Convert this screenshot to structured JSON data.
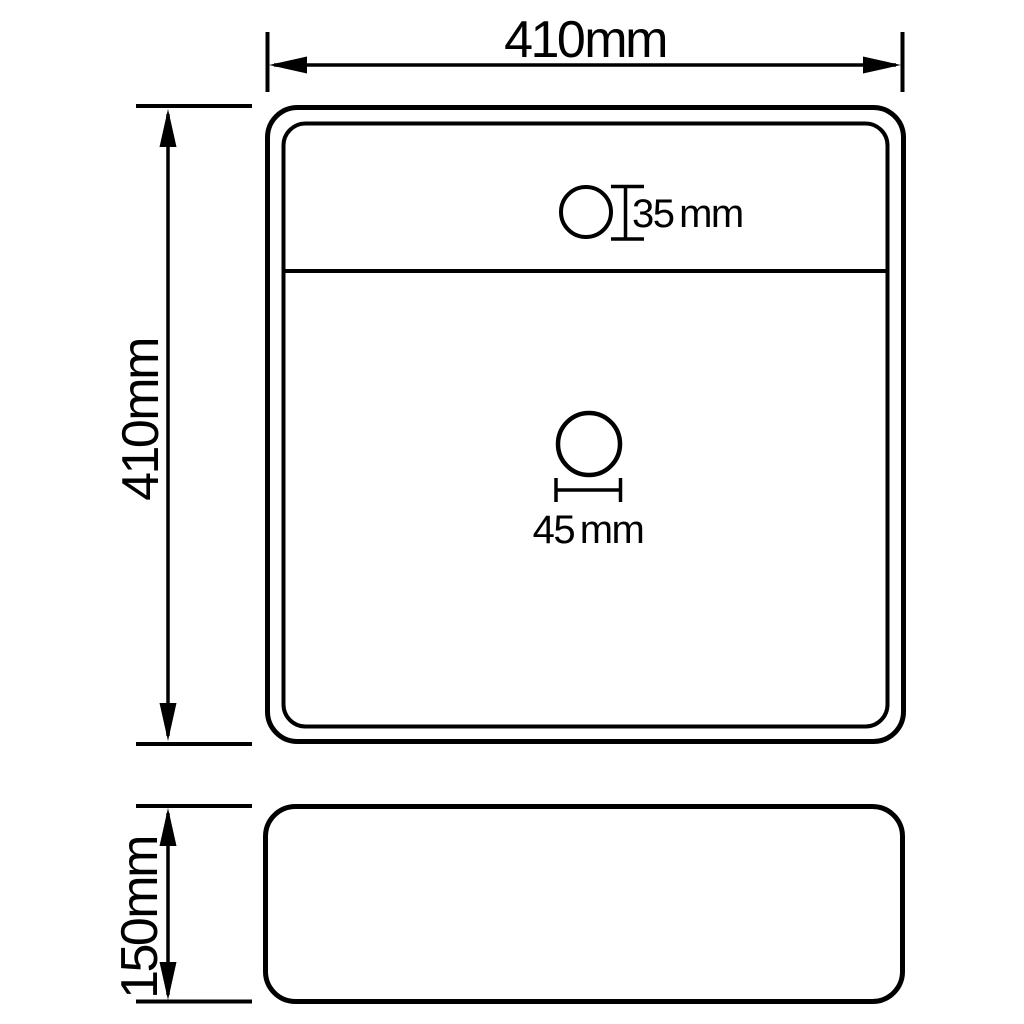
{
  "colors": {
    "line": "#000000",
    "background": "#ffffff"
  },
  "diagram": {
    "labels": {
      "top_width": "410 mm",
      "left_height": "410 mm",
      "faucet_hole": "35 mm",
      "drain_hole": "45 mm",
      "side_height": "150 mm"
    }
  }
}
